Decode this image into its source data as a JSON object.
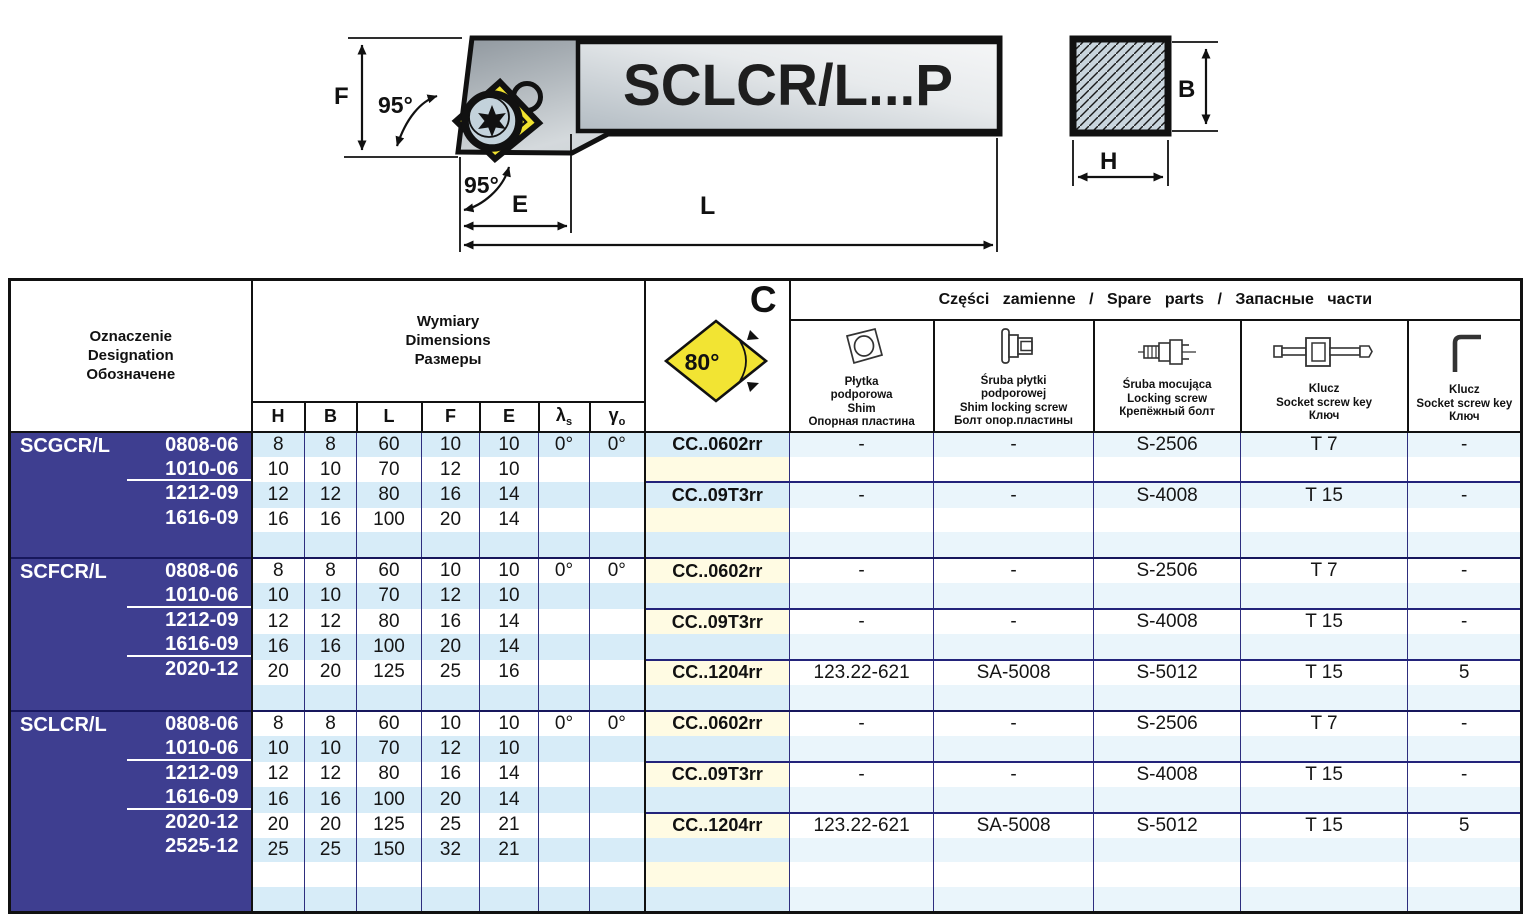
{
  "diagram": {
    "holder_label": "SCLCR/L...P",
    "dim_F": "F",
    "dim_E": "E",
    "dim_L": "L",
    "dim_B": "B",
    "dim_H": "H",
    "angle_main": "95°",
    "angle_secondary": "95°"
  },
  "table": {
    "designation_header": [
      "Oznaczenie",
      "Designation",
      "Обозначене"
    ],
    "dimensions_header": [
      "Wymiary",
      "Dimensions",
      "Размеры"
    ],
    "dim_columns": [
      {
        "base": "H",
        "sub": ""
      },
      {
        "base": "B",
        "sub": ""
      },
      {
        "base": "L",
        "sub": ""
      },
      {
        "base": "F",
        "sub": ""
      },
      {
        "base": "E",
        "sub": ""
      },
      {
        "base": "λ",
        "sub": "s"
      },
      {
        "base": "γ",
        "sub": "o"
      }
    ],
    "insert_header": {
      "letter": "C",
      "angle": "80°"
    },
    "spare_parts_title": "Części zamienne / Spare parts / Запасные части",
    "spare_columns": [
      {
        "icon": "shim-icon",
        "lines": [
          "Płytka",
          "podporowa",
          "Shim",
          "Опорная пластина"
        ]
      },
      {
        "icon": "shim-locking-screw-icon",
        "lines": [
          "Śruba płytki",
          "podporowej",
          "Shim locking screw",
          "Болт опор.пластины"
        ]
      },
      {
        "icon": "locking-screw-icon",
        "lines": [
          "Śruba mocująca",
          "Locking screw",
          "Крепёжный болт"
        ]
      },
      {
        "icon": "socket-screw-key-icon",
        "lines": [
          "Klucz",
          "Socket screw key",
          "Ключ"
        ]
      },
      {
        "icon": "hex-key-icon",
        "lines": [
          "Klucz",
          "Socket screw key",
          "Ключ"
        ]
      }
    ],
    "groups": [
      {
        "name": "SCGCR/L",
        "rows": [
          {
            "size": "0808-06",
            "dims": [
              "8",
              "8",
              "60",
              "10",
              "10"
            ],
            "lambda": "0°",
            "gamma": "0°",
            "sep": false
          },
          {
            "size": "1010-06",
            "dims": [
              "10",
              "10",
              "70",
              "12",
              "10"
            ],
            "lambda": "",
            "gamma": "",
            "sep": true
          },
          {
            "size": "1212-09",
            "dims": [
              "12",
              "12",
              "80",
              "16",
              "14"
            ],
            "lambda": "",
            "gamma": "",
            "sep": false
          },
          {
            "size": "1616-09",
            "dims": [
              "16",
              "16",
              "100",
              "20",
              "14"
            ],
            "lambda": "",
            "gamma": "",
            "sep": false
          },
          {
            "size": "",
            "dims": [
              "",
              "",
              "",
              "",
              ""
            ],
            "lambda": "",
            "gamma": "",
            "sep": false
          }
        ],
        "subgroups": [
          {
            "start_row": 0,
            "insert": "CC..0602rr",
            "parts": [
              "-",
              "-",
              "S-2506",
              "T 7",
              "-"
            ]
          },
          {
            "start_row": 2,
            "insert": "CC..09T3rr",
            "parts": [
              "-",
              "-",
              "S-4008",
              "T 15",
              "-"
            ]
          }
        ]
      },
      {
        "name": "SCFCR/L",
        "rows": [
          {
            "size": "0808-06",
            "dims": [
              "8",
              "8",
              "60",
              "10",
              "10"
            ],
            "lambda": "0°",
            "gamma": "0°",
            "sep": false
          },
          {
            "size": "1010-06",
            "dims": [
              "10",
              "10",
              "70",
              "12",
              "10"
            ],
            "lambda": "",
            "gamma": "",
            "sep": true
          },
          {
            "size": "1212-09",
            "dims": [
              "12",
              "12",
              "80",
              "16",
              "14"
            ],
            "lambda": "",
            "gamma": "",
            "sep": false
          },
          {
            "size": "1616-09",
            "dims": [
              "16",
              "16",
              "100",
              "20",
              "14"
            ],
            "lambda": "",
            "gamma": "",
            "sep": true
          },
          {
            "size": "2020-12",
            "dims": [
              "20",
              "20",
              "125",
              "25",
              "16"
            ],
            "lambda": "",
            "gamma": "",
            "sep": false
          },
          {
            "size": "",
            "dims": [
              "",
              "",
              "",
              "",
              ""
            ],
            "lambda": "",
            "gamma": "",
            "sep": false
          }
        ],
        "subgroups": [
          {
            "start_row": 0,
            "insert": "CC..0602rr",
            "parts": [
              "-",
              "-",
              "S-2506",
              "T 7",
              "-"
            ]
          },
          {
            "start_row": 2,
            "insert": "CC..09T3rr",
            "parts": [
              "-",
              "-",
              "S-4008",
              "T 15",
              "-"
            ]
          },
          {
            "start_row": 4,
            "insert": "CC..1204rr",
            "parts": [
              "123.22-621",
              "SA-5008",
              "S-5012",
              "T 15",
              "5"
            ]
          }
        ]
      },
      {
        "name": "SCLCR/L",
        "rows": [
          {
            "size": "0808-06",
            "dims": [
              "8",
              "8",
              "60",
              "10",
              "10"
            ],
            "lambda": "0°",
            "gamma": "0°",
            "sep": false
          },
          {
            "size": "1010-06",
            "dims": [
              "10",
              "10",
              "70",
              "12",
              "10"
            ],
            "lambda": "",
            "gamma": "",
            "sep": true
          },
          {
            "size": "1212-09",
            "dims": [
              "12",
              "12",
              "80",
              "16",
              "14"
            ],
            "lambda": "",
            "gamma": "",
            "sep": false
          },
          {
            "size": "1616-09",
            "dims": [
              "16",
              "16",
              "100",
              "20",
              "14"
            ],
            "lambda": "",
            "gamma": "",
            "sep": true
          },
          {
            "size": "2020-12",
            "dims": [
              "20",
              "20",
              "125",
              "25",
              "21"
            ],
            "lambda": "",
            "gamma": "",
            "sep": false
          },
          {
            "size": "2525-12",
            "dims": [
              "25",
              "25",
              "150",
              "32",
              "21"
            ],
            "lambda": "",
            "gamma": "",
            "sep": false
          },
          {
            "size": "",
            "dims": [
              "",
              "",
              "",
              "",
              ""
            ],
            "lambda": "",
            "gamma": "",
            "sep": false
          },
          {
            "size": "",
            "dims": [
              "",
              "",
              "",
              "",
              ""
            ],
            "lambda": "",
            "gamma": "",
            "sep": false
          }
        ],
        "subgroups": [
          {
            "start_row": 0,
            "insert": "CC..0602rr",
            "parts": [
              "-",
              "-",
              "S-2506",
              "T 7",
              "-"
            ]
          },
          {
            "start_row": 2,
            "insert": "CC..09T3rr",
            "parts": [
              "-",
              "-",
              "S-4008",
              "T 15",
              "-"
            ]
          },
          {
            "start_row": 4,
            "insert": "CC..1204rr",
            "parts": [
              "123.22-621",
              "SA-5008",
              "S-5012",
              "T 15",
              "5"
            ]
          }
        ]
      }
    ]
  }
}
